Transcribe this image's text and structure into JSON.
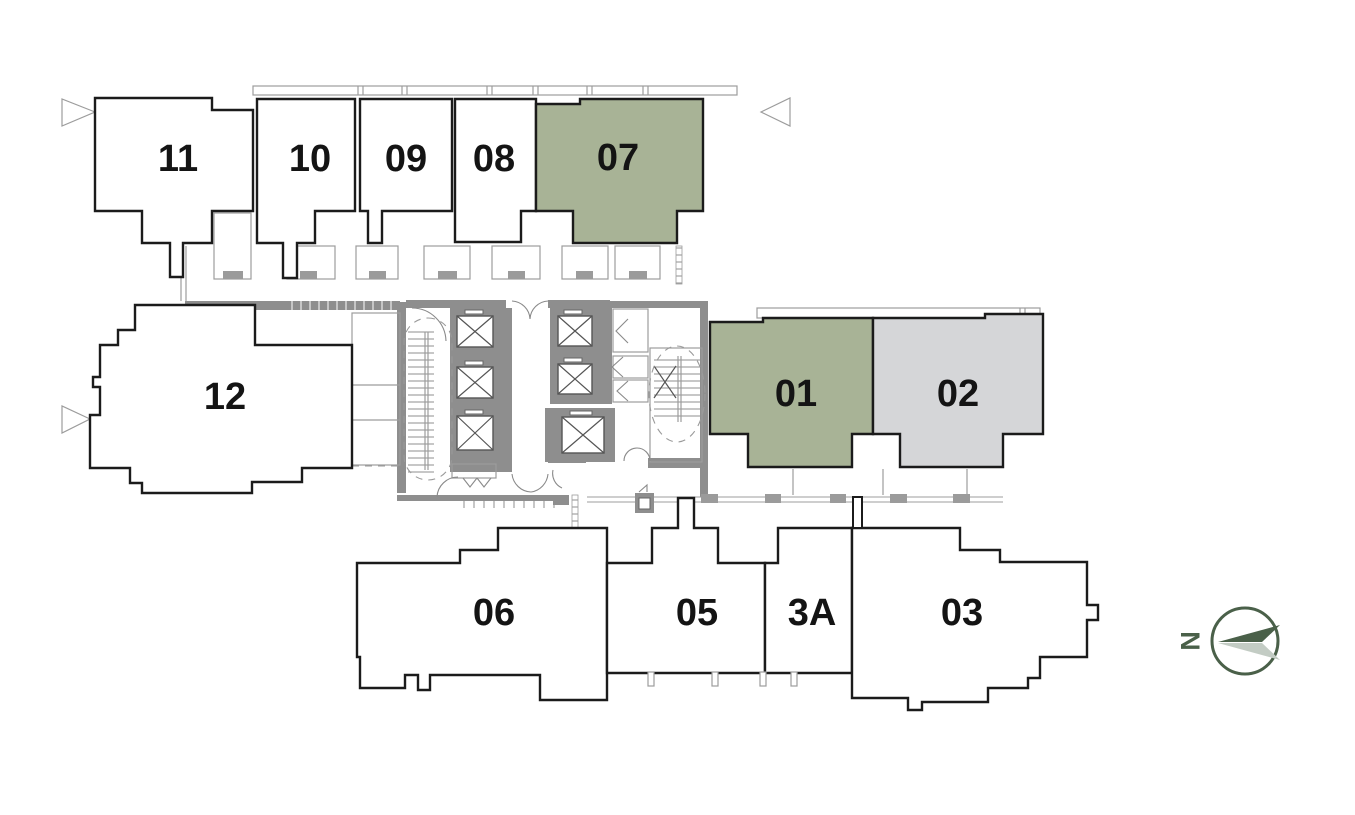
{
  "units": [
    {
      "id": "11",
      "label": "11",
      "fill": "#ffffff",
      "status": "standard"
    },
    {
      "id": "10",
      "label": "10",
      "fill": "#ffffff",
      "status": "standard"
    },
    {
      "id": "09",
      "label": "09",
      "fill": "#ffffff",
      "status": "standard"
    },
    {
      "id": "08",
      "label": "08",
      "fill": "#ffffff",
      "status": "standard"
    },
    {
      "id": "07",
      "label": "07",
      "fill": "#a8b396",
      "status": "highlighted-green"
    },
    {
      "id": "12",
      "label": "12",
      "fill": "#ffffff",
      "status": "standard"
    },
    {
      "id": "01",
      "label": "01",
      "fill": "#a8b396",
      "status": "highlighted-green"
    },
    {
      "id": "02",
      "label": "02",
      "fill": "#d5d6d8",
      "status": "highlighted-gray"
    },
    {
      "id": "06",
      "label": "06",
      "fill": "#ffffff",
      "status": "standard"
    },
    {
      "id": "05",
      "label": "05",
      "fill": "#ffffff",
      "status": "standard"
    },
    {
      "id": "3A",
      "label": "3A",
      "fill": "#ffffff",
      "status": "standard"
    },
    {
      "id": "03",
      "label": "03",
      "fill": "#ffffff",
      "status": "standard"
    }
  ],
  "compass": {
    "label": "N",
    "dark": "#4a6049",
    "light": "#c3ccc4"
  },
  "colors": {
    "unit_outline": "#1b1b1b",
    "wall_gray": "#8e8e8e",
    "detail_gray": "#9b9b9b",
    "highlight_green": "#a8b396",
    "highlight_gray": "#d5d6d8"
  }
}
